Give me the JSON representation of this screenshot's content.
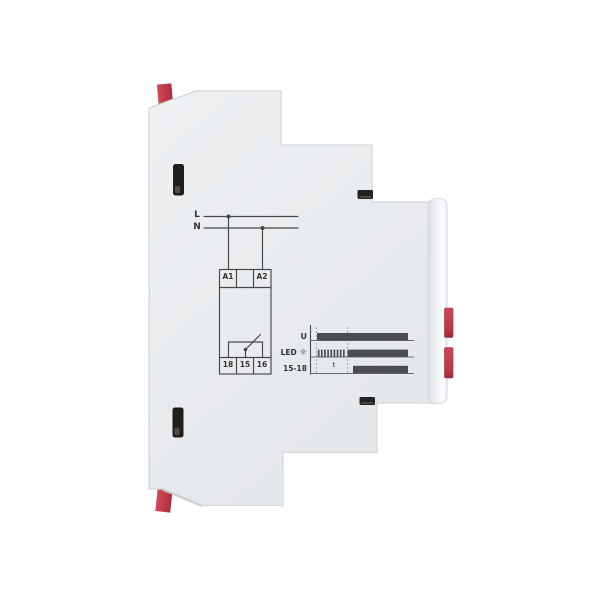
{
  "device": {
    "kind": "din-rail-module-side-view",
    "colors": {
      "body_gray": "#e9ebee",
      "accent_red": "#c6404f",
      "slot_black": "#211e1c",
      "diagram_line": "#474747",
      "timing_bar": "#4b4d4f",
      "background": "#ffffff"
    }
  },
  "wiring": {
    "phase_label": "L",
    "neutral_label": "N",
    "coil_terminals": [
      "A1",
      "A2"
    ],
    "contact_terminals": [
      "18",
      "15",
      "16"
    ]
  },
  "timing": {
    "rows": [
      {
        "label": "U",
        "pattern": "high-from-power-on"
      },
      {
        "label": "LED",
        "pattern": "blink-then-high"
      },
      {
        "label": "15-18",
        "pattern": "delayed-high"
      }
    ],
    "led_icon": "☼",
    "delay_label": "t"
  }
}
